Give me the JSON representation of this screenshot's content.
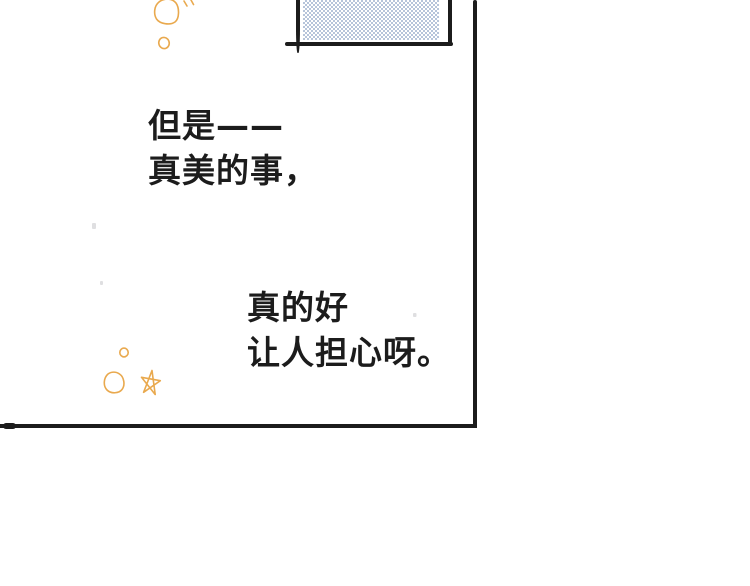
{
  "type": "comic-panel",
  "colors": {
    "paper": "#ffffff",
    "ink": "#1c1c1c",
    "doodle": "#e9a94e",
    "screentone": "#b6c4da",
    "speck": "#c4c4c8"
  },
  "captions": {
    "top": {
      "line1": "但是——",
      "line2": "真美的事，"
    },
    "bottom": {
      "line1": "真的好",
      "line2": "让人担心呀。"
    }
  },
  "decorations": {
    "screentone_pattern": "halftone-checker",
    "doodles": [
      "large-circle-top",
      "tick-marks-top",
      "small-circle-top",
      "small-circle-bottom",
      "ring-circle-bottom",
      "star-bottom"
    ]
  }
}
